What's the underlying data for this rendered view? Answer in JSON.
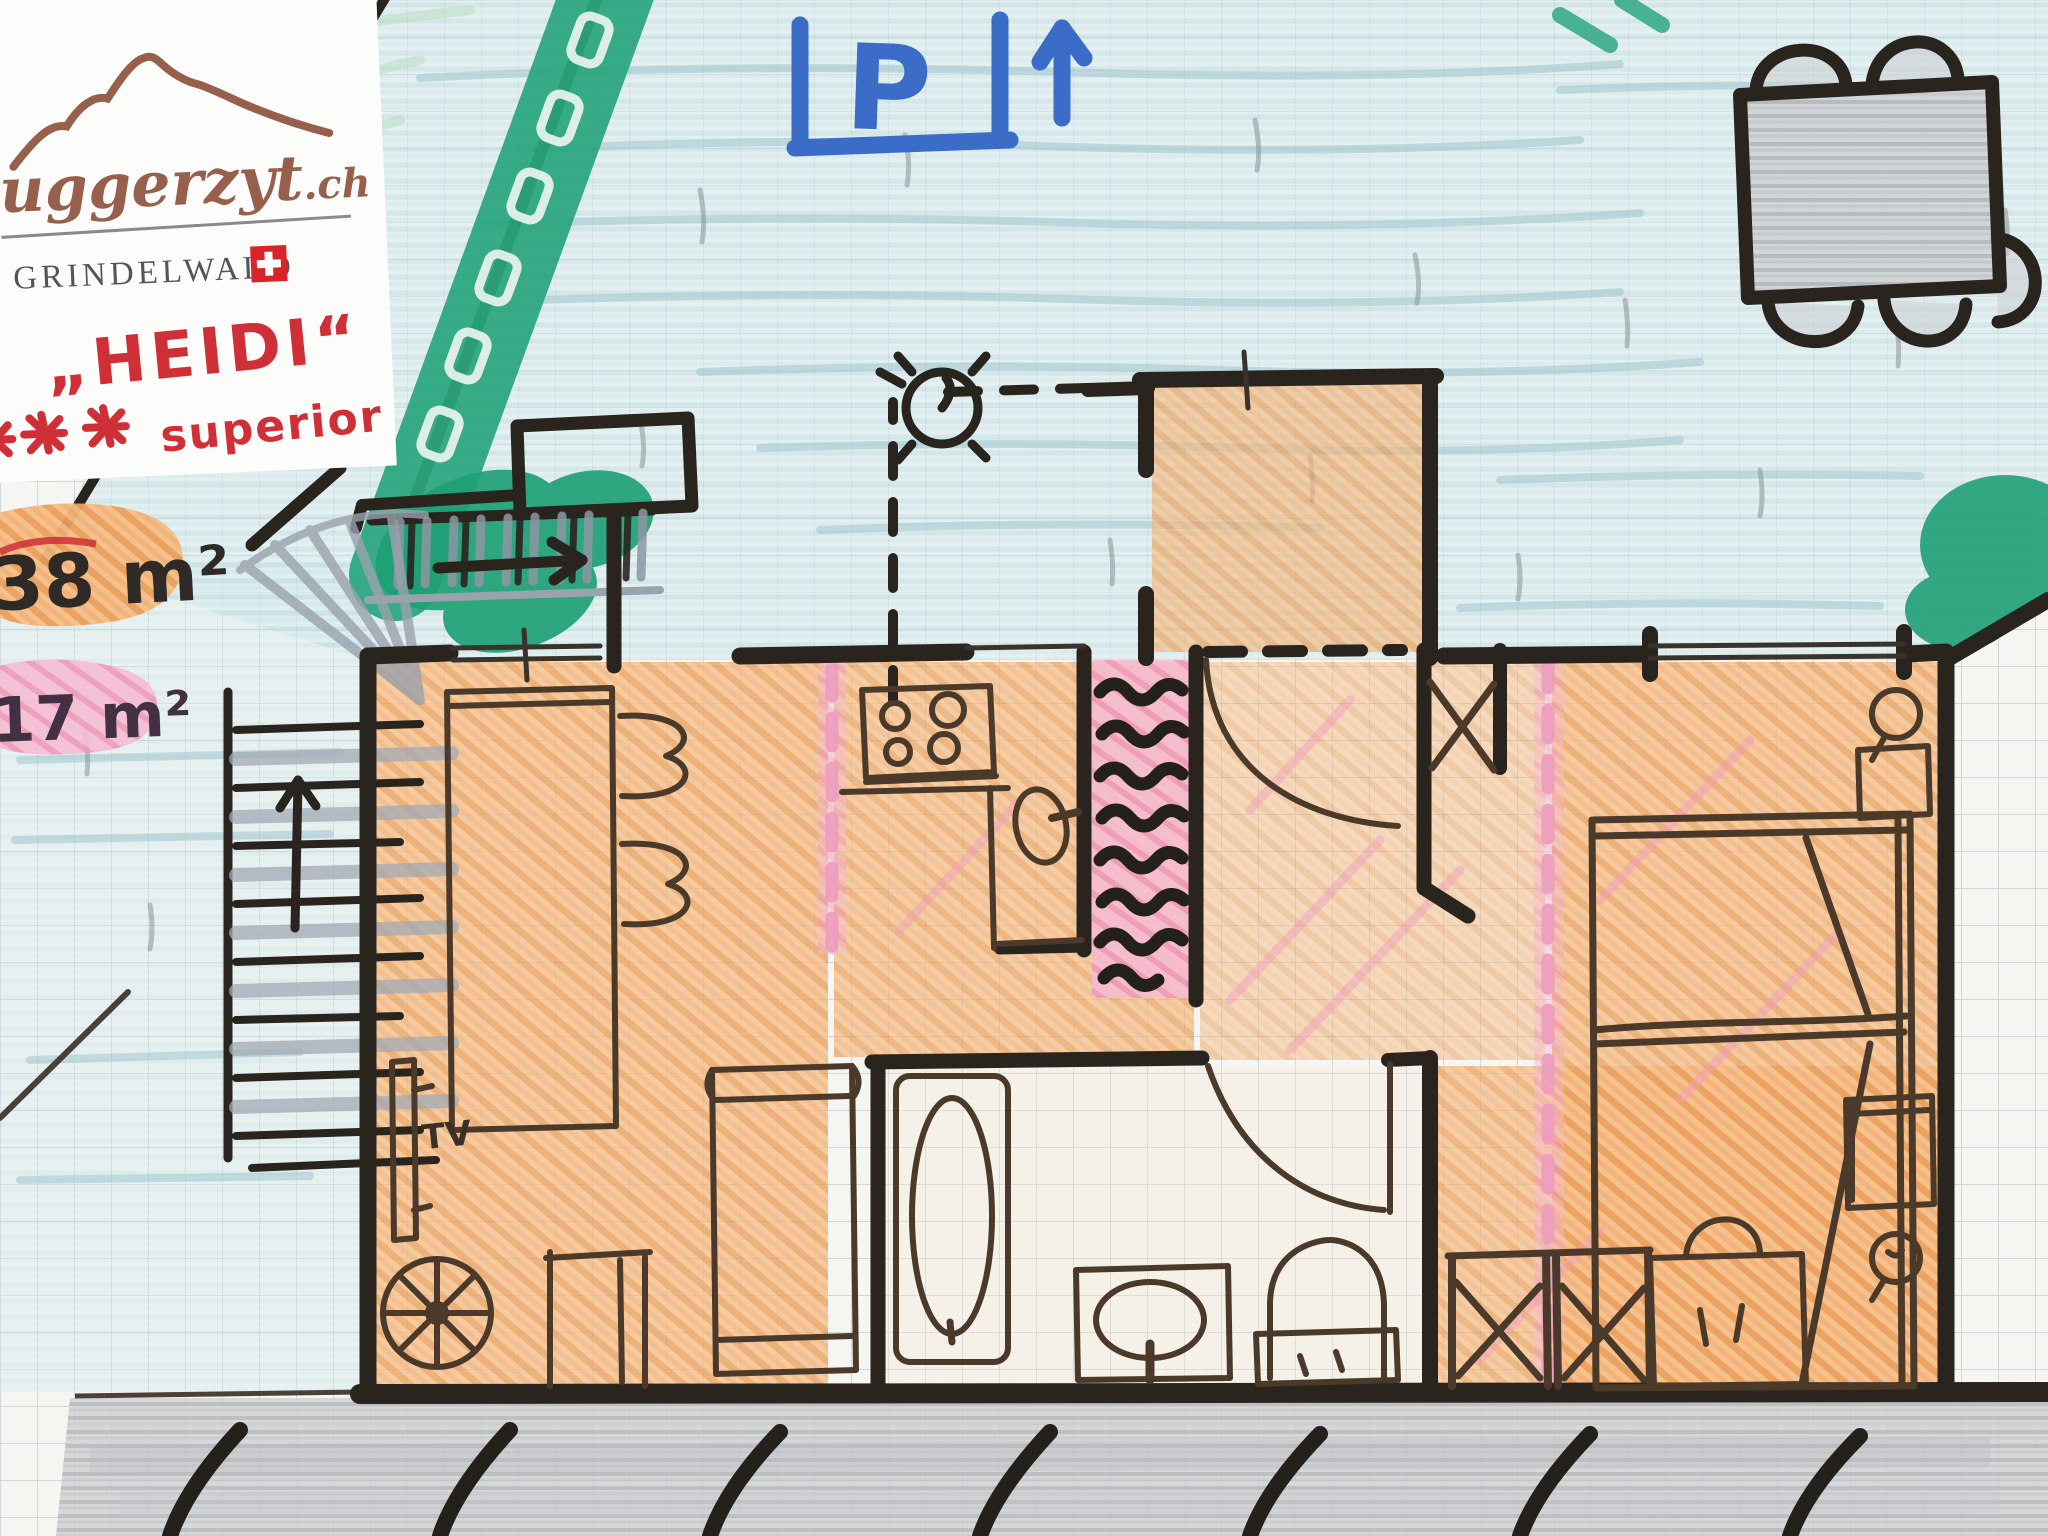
{
  "logo": {
    "brand": "uggerzyt",
    "tld": ".ch",
    "location": "GRINDELWALD"
  },
  "unit": {
    "name": "„HEIDI“",
    "stars_visible": 2,
    "rating_label": "superior"
  },
  "areas": {
    "apartment": "38 m²",
    "second": "17 m²"
  },
  "signs": {
    "parking_letter": "P",
    "tv_label": "TV"
  },
  "colors": {
    "marker_ink": "#2a241f",
    "marker_blue": "#3a6cc8",
    "marker_red": "#cf2f36",
    "logo_brown": "#96604d",
    "crayon_orange": "#f0a45c",
    "crayon_pink": "#f2aec9",
    "crayon_green": "#25a47b",
    "crayon_blue": "#cfe6ea",
    "crayon_gray": "#c9cccf"
  },
  "plan_features": [
    "outdoor-dining-table",
    "parking-direction-sign",
    "hedge-path",
    "entrance-stairs",
    "spiral-stairs",
    "dining-table",
    "tv",
    "spinning-wheel",
    "sofa",
    "kitchen-stove",
    "kitchen-sink",
    "interior-stairs",
    "wardrobe-closet",
    "bathtub",
    "washbasin",
    "toilet",
    "double-bed",
    "nightstand-lamp",
    "single-bed",
    "wardrobes",
    "desk-lamp",
    "terrace-hatching"
  ]
}
